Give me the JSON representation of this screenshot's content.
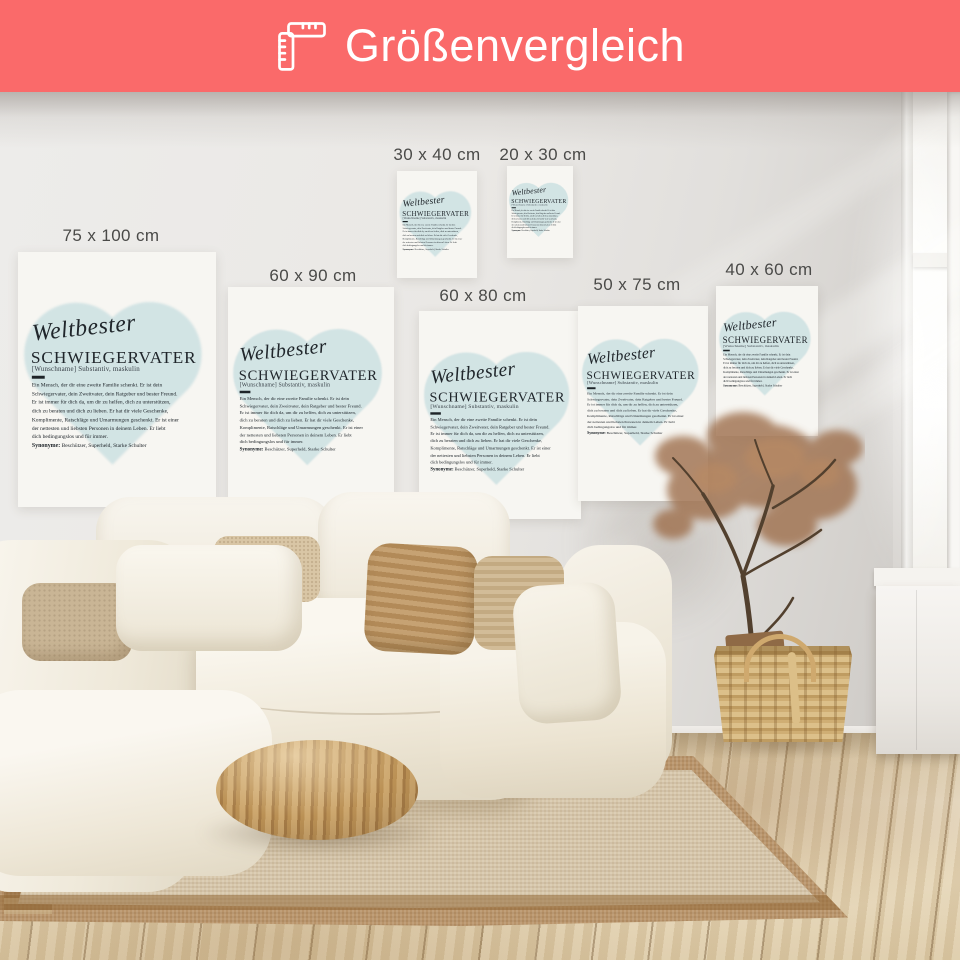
{
  "header": {
    "title": "Größenvergleich",
    "icon": "folding-ruler-icon",
    "bg_color": "#fa6a6a",
    "text_color": "#ffffff"
  },
  "size_labels": {
    "s75x100": "75 x 100 cm",
    "s60x90": "60 x 90 cm",
    "s30x40": "30 x 40 cm",
    "s20x30": "20 x 30 cm",
    "s60x80": "60 x 80 cm",
    "s50x75": "50 x 75 cm",
    "s40x60": "40 x 60 cm"
  },
  "poster": {
    "script_title": "Weltbester",
    "main_title": "SCHWIEGERVATER",
    "subtitle": "[Wunschname] Substantiv, maskulin",
    "body_lines": [
      "Ein Mensch, der dir eine zweite Familie schenkt. Er ist dein",
      "Schwiegervater, dein Zweitvater, dein Ratgeber und bester Freund.",
      "Er ist immer für dich da, um dir zu helfen, dich zu unterstützen,",
      "dich zu beraten und dich zu lieben. Er hat dir viele Geschenke,",
      "Komplimente, Ratschläge und Umarmungen geschenkt. Er ist einer",
      "der nettesten und liebsten Personen in deinem Leben. Er liebt",
      "dich bedingungslos und für immer."
    ],
    "synonyms_label": "Synonyme:",
    "synonyms": "Beschützer, Superheld, Starke Schulter",
    "heart_color": "#cfe2e3",
    "text_color": "#20262b"
  },
  "scene": {
    "wall_color": "#e9e6e2",
    "floor_color": "#e3d5bb",
    "rug_color": "#d7c7ab",
    "rug_border_color": "#b9946a",
    "sofa_color": "#f4f0e7",
    "pouf_color": "#b9925f",
    "basket_color": "#d2b27c",
    "plant_color": "#9e6f4c"
  }
}
